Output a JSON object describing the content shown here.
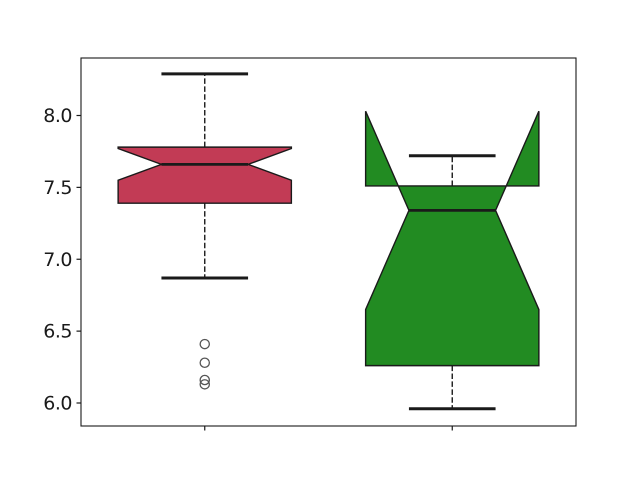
{
  "figure": {
    "background": "#ffffff"
  },
  "chart_data": {
    "type": "boxplot",
    "notched": true,
    "orientation": "vertical",
    "grid": false,
    "legend": null,
    "xlim": [
      0.5,
      2.5
    ],
    "ylim": [
      5.84,
      8.4
    ],
    "yticks": [
      6.0,
      6.5,
      7.0,
      7.5,
      8.0
    ],
    "ytick_labels": [
      "6.0",
      "6.5",
      "7.0",
      "7.5",
      "8.0"
    ],
    "xticks": [
      1,
      2
    ],
    "box_width": 0.7,
    "cap_width": 0.35,
    "median_width": 0.35,
    "axis_color": "#1a1a1a",
    "tick_label_color": "#1a1a1a",
    "flier_color": "#555555",
    "boxes": [
      {
        "name": "box-1",
        "position": 1,
        "fill_color": "#c23b55",
        "edge_color": "#1a1a1a",
        "whisker_low": 6.87,
        "q1": 7.39,
        "median": 7.66,
        "q3": 7.78,
        "whisker_high": 8.29,
        "notch_low": 7.55,
        "notch_high": 7.77,
        "outliers": [
          6.41,
          6.28,
          6.16,
          6.13
        ]
      },
      {
        "name": "box-2",
        "position": 2,
        "fill_color": "#228b22",
        "edge_color": "#1a1a1a",
        "whisker_low": 5.96,
        "q1": 6.26,
        "median": 7.34,
        "q3": 7.51,
        "whisker_high": 7.72,
        "notch_low": 6.65,
        "notch_high": 8.03,
        "outliers": []
      }
    ]
  }
}
